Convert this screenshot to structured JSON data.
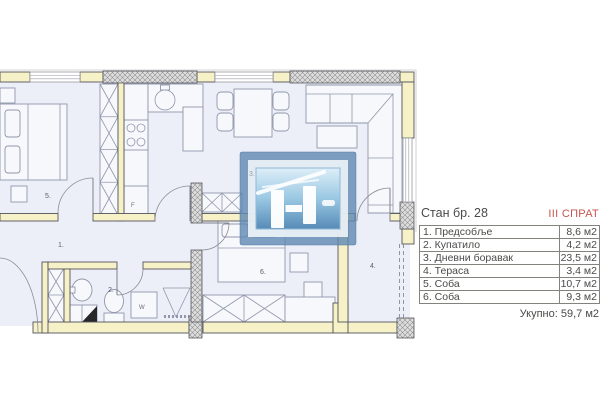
{
  "info_panel": {
    "apartment": "Стан бр. 28",
    "floor": "III СПРАТ",
    "rooms": [
      {
        "label": "1. Предсобље",
        "area": "8,6 м2"
      },
      {
        "label": "2. Купатило",
        "area": "4,2 м2"
      },
      {
        "label": "3. Дневни боравак",
        "area": "23,5 м2"
      },
      {
        "label": "4. Тераса",
        "area": "3,4 м2"
      },
      {
        "label": "5. Соба",
        "area": "10,7 м2"
      },
      {
        "label": "6. Соба",
        "area": "9,3 м2"
      }
    ],
    "total": "Укупно: 59,7 м2"
  },
  "plan": {
    "labels": {
      "hallway": "1.",
      "bathroom": "2.",
      "living": "3.",
      "terrace": "4.",
      "bedroom": "5.",
      "bedroom2": "6.",
      "fridge": "F",
      "washer": "W"
    }
  },
  "colors": {
    "wall_fill": "#f6f1c6",
    "floor_fill": "#edeff8",
    "accent_red": "#c5544f",
    "logo_blue": "#5f88b2",
    "text": "#4a4a48"
  }
}
